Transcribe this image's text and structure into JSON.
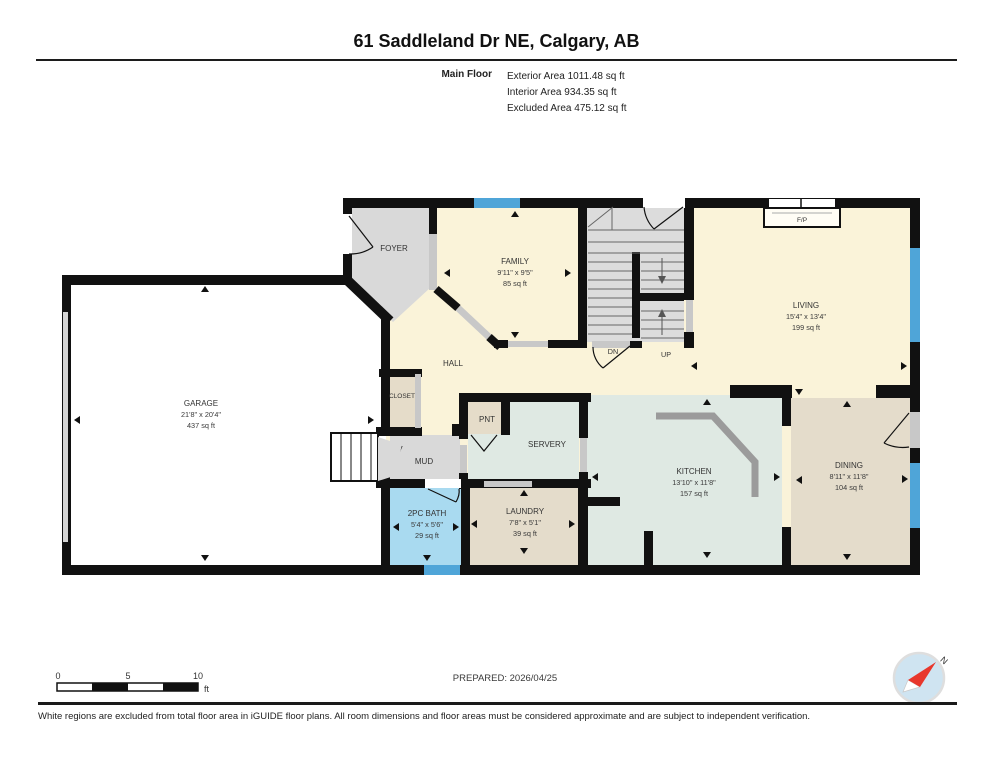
{
  "header": {
    "title": "61 Saddleland Dr NE, Calgary, AB",
    "floor_label": "Main Floor",
    "exterior_area": "Exterior Area 1011.48 sq ft",
    "interior_area": "Interior Area 934.35 sq ft",
    "excluded_area": "Excluded Area 475.12 sq ft"
  },
  "rooms": {
    "garage": {
      "name": "GARAGE",
      "dims": "21'8\" x 20'4\"",
      "area": "437 sq ft"
    },
    "foyer": {
      "name": "FOYER"
    },
    "family": {
      "name": "FAMILY",
      "dims": "9'11\" x 9'5\"",
      "area": "85 sq ft"
    },
    "hall": {
      "name": "HALL"
    },
    "closet": {
      "name": "CLOSET"
    },
    "mud": {
      "name": "MUD"
    },
    "pantry": {
      "name": "PNT"
    },
    "servery": {
      "name": "SERVERY"
    },
    "living": {
      "name": "LIVING",
      "dims": "15'4\" x 13'4\"",
      "area": "199 sq ft"
    },
    "kitchen": {
      "name": "KITCHEN",
      "dims": "13'10\" x 11'8\"",
      "area": "157 sq ft"
    },
    "dining": {
      "name": "DINING",
      "dims": "8'11\" x 11'8\"",
      "area": "104 sq ft"
    },
    "bath": {
      "name": "2PC BATH",
      "dims": "5'4\" x 5'6\"",
      "area": "29 sq ft"
    },
    "laundry": {
      "name": "LAUNDRY",
      "dims": "7'8\" x 5'1\"",
      "area": "39 sq ft"
    }
  },
  "stairs": {
    "down": "DN",
    "up": "UP"
  },
  "fireplace": {
    "label": "F/P"
  },
  "scale_bar": {
    "tick0": "0",
    "tick5": "5",
    "tick10": "10",
    "unit": "ft"
  },
  "compass": {
    "north": "N"
  },
  "footer": {
    "prepared": "PREPARED: 2026/04/25",
    "disclaimer": "White regions are excluded from total floor area in iGUIDE floor plans. All room dimensions and floor areas must be considered approximate and are subject to independent verification."
  },
  "colors": {
    "wall": "#111111",
    "interior_cream": "#faf3d9",
    "gray_room": "#d9d9d9",
    "mint": "#dfe9e3",
    "beige": "#e5dcc9",
    "tan": "#e4dccb",
    "bath_blue": "#a9daf0",
    "window_blue": "#4fa5d8",
    "stair_gray": "#dcdcdc",
    "compass_red": "#e8372c"
  }
}
